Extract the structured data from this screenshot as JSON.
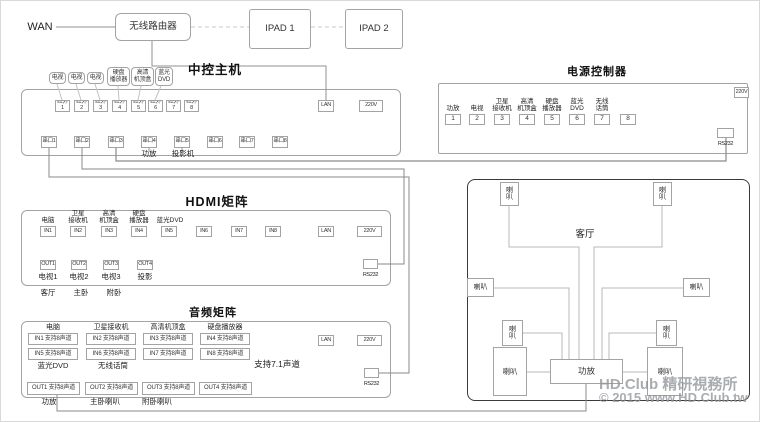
{
  "network": {
    "wan": "WAN",
    "router": "无线路由器",
    "ipad1": "IPAD 1",
    "ipad2": "IPAD 2"
  },
  "central": {
    "title": "中控主机",
    "device_labels": [
      "电视",
      "电视",
      "电视",
      "硬盘\n播放器",
      "高清\n机顶盒",
      "蓝光\nDVD"
    ],
    "ir_ports": [
      "红外1",
      "红外2",
      "红外3",
      "红外4",
      "红外5",
      "红外6",
      "红外7",
      "红外8"
    ],
    "lan": "LAN",
    "power": "220V",
    "serial_ports": [
      "串口1",
      "串口2",
      "串口3",
      "串口4",
      "串口5",
      "串口6",
      "串口7",
      "串口8"
    ],
    "serial4_label": "功放",
    "serial5_label": "投影机"
  },
  "power_controller": {
    "title": "电源控制器",
    "channels": [
      {
        "label": "功放",
        "num": "1"
      },
      {
        "label": "电视",
        "num": "2"
      },
      {
        "label": "卫星\n接收机",
        "num": "3"
      },
      {
        "label": "高清\n机顶盒",
        "num": "4"
      },
      {
        "label": "硬盘\n播放器",
        "num": "5"
      },
      {
        "label": "蓝光\nDVD",
        "num": "6"
      },
      {
        "label": "无线\n话筒",
        "num": "7"
      },
      {
        "label": "",
        "num": "8"
      }
    ],
    "power": "220V",
    "rs232": "RS232"
  },
  "hdmi_matrix": {
    "title": "HDMI矩阵",
    "input_labels": [
      "电脑",
      "卫星\n接收机",
      "高清\n机顶盒",
      "硬盘\n播放器",
      "蓝光DVD"
    ],
    "inputs": [
      "IN1",
      "IN2",
      "IN3",
      "IN4",
      "IN5",
      "IN6",
      "IN7",
      "IN8"
    ],
    "lan": "LAN",
    "power": "220V",
    "outputs": [
      {
        "port": "OUT1",
        "device": "电视1",
        "room": "客厅"
      },
      {
        "port": "OUT2",
        "device": "电视2",
        "room": "主卧"
      },
      {
        "port": "OUT3",
        "device": "电视3",
        "room": "附卧"
      },
      {
        "port": "OUT4",
        "device": "投影",
        "room": ""
      }
    ],
    "rs232": "RS232"
  },
  "audio_matrix": {
    "title": "音频矩阵",
    "input_labels_top": [
      "电脑",
      "卫星接收机",
      "高清机顶盒",
      "硬盘播放器"
    ],
    "inputs_row1": [
      "IN1 支持8声道",
      "IN2 支持8声道",
      "IN3 支持8声道",
      "IN4 支持8声道"
    ],
    "inputs_row2": [
      "IN5 支持8声道",
      "IN6 支持8声道",
      "IN7 支持8声道",
      "IN8 支持8声道"
    ],
    "input_labels_bottom": [
      "蓝光DVD",
      "无线话筒"
    ],
    "note": "支持7.1声道",
    "outputs": [
      "OUT1 支持8声道",
      "OUT2 支持8声道",
      "OUT3 支持8声道",
      "OUT4 支持8声道"
    ],
    "output_labels": [
      "功放",
      "主卧喇叭",
      "附卧喇叭"
    ],
    "lan": "LAN",
    "power": "220V",
    "rs232": "RS232"
  },
  "living_room": {
    "title": "客厅",
    "speaker_v": "喇\n叭",
    "speaker_h": "喇叭",
    "amp": "功放"
  },
  "watermark": {
    "line1": "HD.Club 精研視務所",
    "line2": "© 2015 www.HD.Club.tw"
  },
  "colors": {
    "wire": "#909090",
    "wire_light": "#b8b8b8",
    "dashed": "#c8c8c8",
    "box_border": "#a3a3a3",
    "room_border": "#3a3a3a",
    "watermark": "#9196a0"
  }
}
